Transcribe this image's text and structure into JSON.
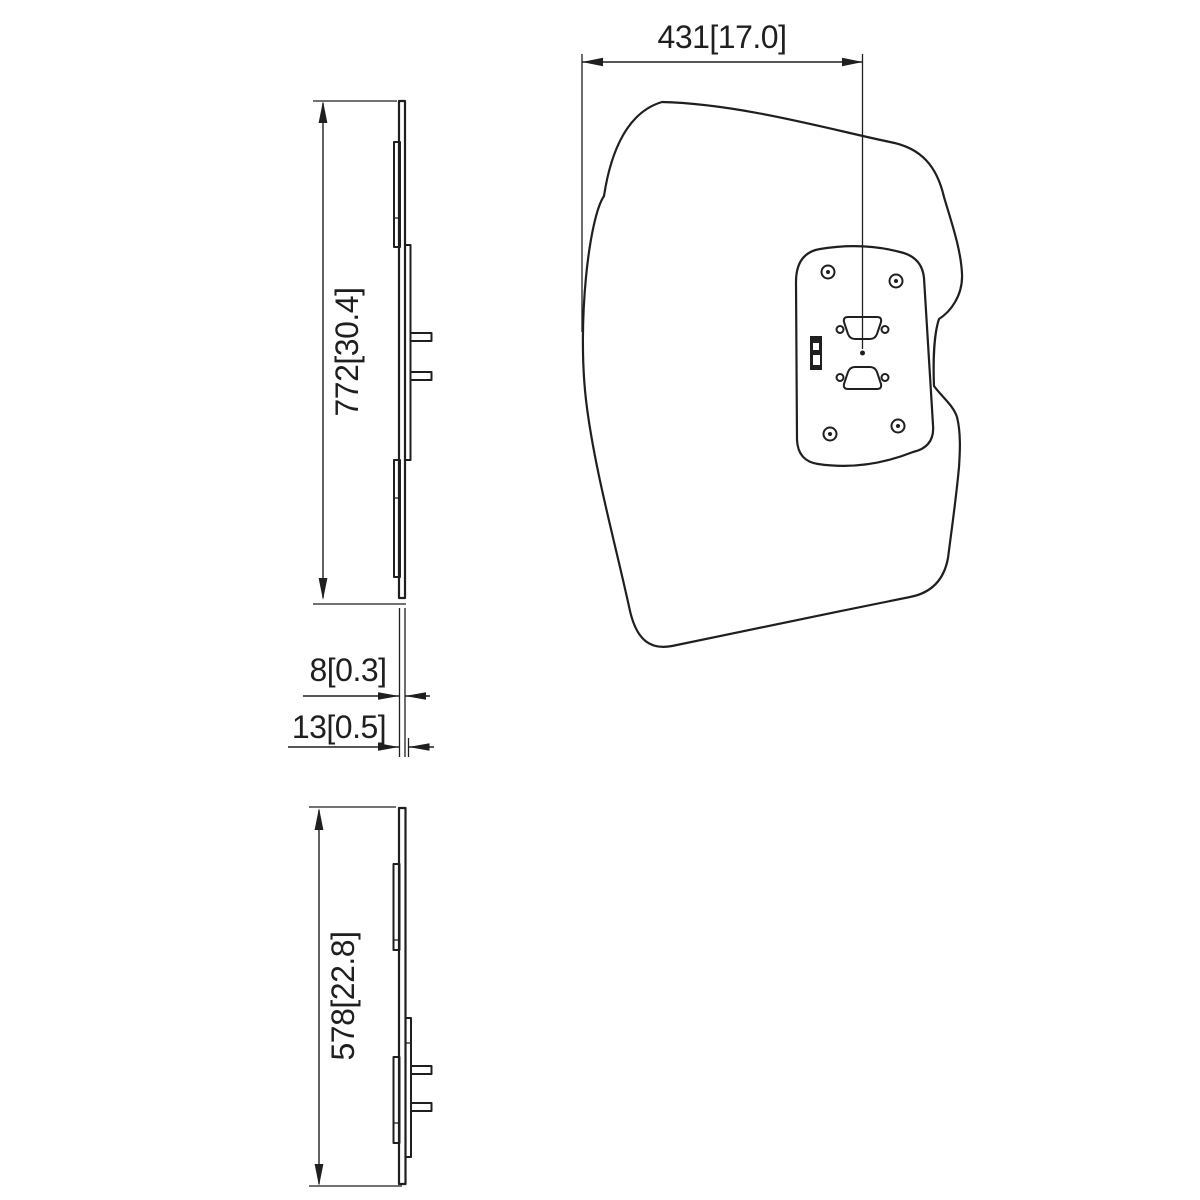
{
  "drawing": {
    "type": "technical-dimension-drawing",
    "background_color": "#ffffff",
    "line_color": "#1f1f1f",
    "views": {
      "side_top": {
        "dimension_height": "772[30.4]",
        "dimension_thickness_glass": "8[0.3]",
        "dimension_thickness_total": "13[0.5]"
      },
      "front": {
        "dimension_width": "431[17.0]"
      },
      "side_bottom": {
        "dimension_height": "578[22.8]"
      }
    }
  }
}
